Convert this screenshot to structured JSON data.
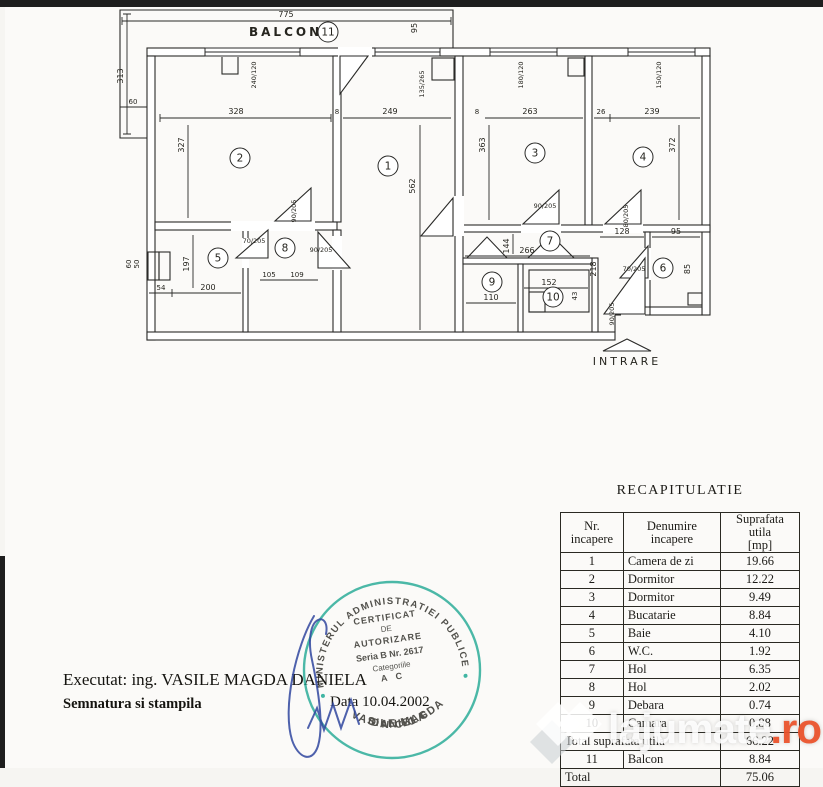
{
  "plan": {
    "balcony_label": "BALCON",
    "entrance_label": "INTRARE",
    "rooms": {
      "r1": "1",
      "r2": "2",
      "r3": "3",
      "r4": "4",
      "r5": "5",
      "r6": "6",
      "r7": "7",
      "r8": "8",
      "r9": "9",
      "r10": "10",
      "r11": "11"
    },
    "dims": {
      "d775": "775",
      "d95t": "95",
      "d313": "313",
      "d60l": "60",
      "d328": "328",
      "d8a": "8",
      "d249": "249",
      "d327": "327",
      "d562": "562",
      "d8b": "8",
      "d263": "263",
      "d363": "363",
      "d26": "26",
      "d239": "239",
      "d372": "372",
      "d197": "197",
      "d200": "200",
      "d54": "54",
      "d50": "50",
      "d60s": "60",
      "d105": "105",
      "d109": "109",
      "d266": "266",
      "d144": "144",
      "d110": "110",
      "d152": "152",
      "d43": "43",
      "d128": "128",
      "d95r": "95",
      "d218": "218",
      "d85": "85"
    },
    "doors": {
      "f1": "70/205",
      "f2": "90/205",
      "f3": "90/205",
      "f4": "90/205",
      "f5": "80/205",
      "f6": "70/205",
      "f7": "90/205"
    },
    "windows": {
      "w1": "240/120",
      "w2": "135/265",
      "w3": "180/120",
      "w4": "150/120"
    }
  },
  "table": {
    "title": "RECAPITULATIE",
    "headers": {
      "h1a": "Nr.",
      "h1b": "incapere",
      "h2a": "Denumire",
      "h2b": "incapere",
      "h3a": "Suprafata utila",
      "h3b": "[mp]"
    },
    "rows": [
      {
        "nr": "1",
        "name": "Camera de zi",
        "area": "19.66"
      },
      {
        "nr": "2",
        "name": "Dormitor",
        "area": "12.22"
      },
      {
        "nr": "3",
        "name": "Dormitor",
        "area": "9.49"
      },
      {
        "nr": "4",
        "name": "Bucatarie",
        "area": "8.84"
      },
      {
        "nr": "5",
        "name": "Baie",
        "area": "4.10"
      },
      {
        "nr": "6",
        "name": "W.C.",
        "area": "1.92"
      },
      {
        "nr": "7",
        "name": "Hol",
        "area": "6.35"
      },
      {
        "nr": "8",
        "name": "Hol",
        "area": "2.02"
      },
      {
        "nr": "9",
        "name": "Debara",
        "area": "0.74"
      },
      {
        "nr": "10",
        "name": "Camara",
        "area": "0.88"
      }
    ],
    "total_utila_label": "Total suprafata utila",
    "total_utila": "66.22",
    "balcony_row": {
      "nr": "11",
      "name": "Balcon",
      "area": "8.84"
    },
    "total_label": "Total",
    "total": "75.06"
  },
  "footer": {
    "executat": "Executat: ing. VASILE MAGDA DANIELA",
    "semnatura": "Semnatura si stampila",
    "data": "Data 10.04.2002"
  },
  "stamp": {
    "color": "#0fa28c",
    "ring_text": "MINISTERUL ADMINISTRATIEI PUBLICE",
    "line1": "CERTIFICAT",
    "line2": "DE",
    "line3": "AUTORIZARE",
    "line4": "Seria B Nr. 2617",
    "line5": "Categoriile",
    "line6": "A C",
    "name1": "VASILE MAGDA",
    "name2": "DANIELA",
    "bottom": "O N C G C"
  },
  "watermark": {
    "text": "lajumate",
    "tld": ".ro"
  }
}
